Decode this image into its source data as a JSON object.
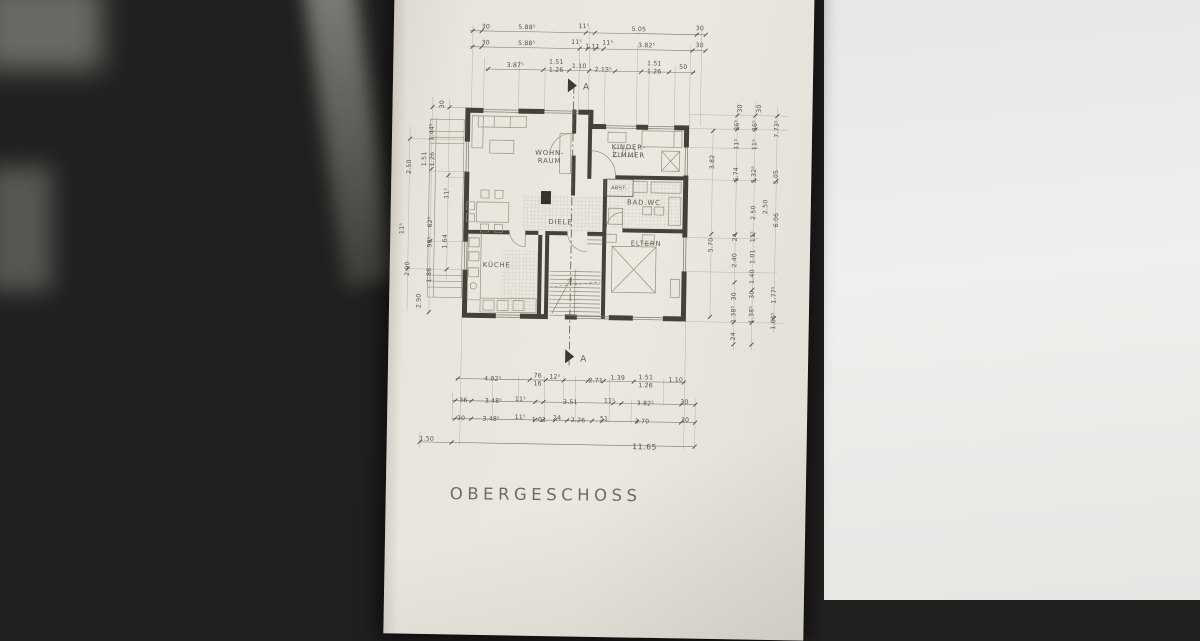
{
  "page_title": "OBERGESCHOSS",
  "section_label": "A",
  "colors": {
    "paper": "#e8e5dd",
    "ink": "#56514a",
    "wall_fill": "#45413a",
    "background": "#21201e",
    "side_surface": "#ecebe9"
  },
  "rooms": [
    {
      "name": "wohnraum",
      "lines": [
        "WOHN-",
        "RAUM"
      ],
      "x": 158,
      "y": 176
    },
    {
      "name": "kinderzimmer",
      "lines": [
        "KINDER-",
        "ZIMMER"
      ],
      "x": 237,
      "y": 169
    },
    {
      "name": "abstellraum",
      "lines": [
        "ABST."
      ],
      "x": 228,
      "y": 206,
      "small": true
    },
    {
      "name": "bad-wc",
      "lines": [
        "BAD.WC"
      ],
      "x": 253,
      "y": 220
    },
    {
      "name": "diele",
      "lines": [
        "DIELE"
      ],
      "x": 170,
      "y": 241
    },
    {
      "name": "eltern",
      "lines": [
        "ELTERN"
      ],
      "x": 256,
      "y": 261
    },
    {
      "name": "kueche",
      "lines": [
        "KÜCHE"
      ],
      "x": 107,
      "y": 285
    }
  ],
  "dim_labels": [
    {
      "t": "30",
      "x": 92,
      "y": 47
    },
    {
      "t": "5.88⁵",
      "x": 133,
      "y": 47
    },
    {
      "t": "11⁵",
      "x": 190,
      "y": 45
    },
    {
      "t": "5.05",
      "x": 245,
      "y": 47
    },
    {
      "t": "30",
      "x": 306,
      "y": 45
    },
    {
      "t": "30",
      "x": 92,
      "y": 63
    },
    {
      "t": "5.88⁵",
      "x": 133,
      "y": 63
    },
    {
      "t": "11⁵",
      "x": 183,
      "y": 61
    },
    {
      "t": "1.11",
      "x": 199,
      "y": 65
    },
    {
      "t": "11⁵",
      "x": 214,
      "y": 61
    },
    {
      "t": "3.82⁵",
      "x": 253,
      "y": 63
    },
    {
      "t": "30",
      "x": 306,
      "y": 62
    },
    {
      "t": "3.87⁵",
      "x": 122,
      "y": 85
    },
    {
      "t": "1.51",
      "x": 163,
      "y": 81
    },
    {
      "t": "1.26",
      "x": 163,
      "y": 89
    },
    {
      "t": "1.10",
      "x": 186,
      "y": 85
    },
    {
      "t": "2.13⁵",
      "x": 210,
      "y": 88
    },
    {
      "t": "1.51",
      "x": 261,
      "y": 81
    },
    {
      "t": "1.26",
      "x": 261,
      "y": 89
    },
    {
      "t": "50",
      "x": 290,
      "y": 84
    },
    {
      "t": "4.02⁵",
      "x": 105,
      "y": 399
    },
    {
      "t": "76",
      "x": 150,
      "y": 395
    },
    {
      "t": "16",
      "x": 150,
      "y": 403
    },
    {
      "t": "12⁵",
      "x": 167,
      "y": 396
    },
    {
      "t": "2.71",
      "x": 208,
      "y": 399
    },
    {
      "t": "1.39",
      "x": 230,
      "y": 396
    },
    {
      "t": "1.51",
      "x": 258,
      "y": 395
    },
    {
      "t": "1.26",
      "x": 258,
      "y": 403
    },
    {
      "t": "1.10",
      "x": 288,
      "y": 397
    },
    {
      "t": "36",
      "x": 76,
      "y": 421
    },
    {
      "t": "3.48⁵",
      "x": 106,
      "y": 421
    },
    {
      "t": "11⁵",
      "x": 133,
      "y": 419
    },
    {
      "t": "3.51",
      "x": 183,
      "y": 421
    },
    {
      "t": "11⁵",
      "x": 222,
      "y": 419
    },
    {
      "t": "3.82⁵",
      "x": 258,
      "y": 421
    },
    {
      "t": "30",
      "x": 297,
      "y": 419
    },
    {
      "t": "30",
      "x": 74,
      "y": 439
    },
    {
      "t": "3.48⁵",
      "x": 104,
      "y": 439
    },
    {
      "t": "11⁵",
      "x": 133,
      "y": 437
    },
    {
      "t": "1.01",
      "x": 152,
      "y": 439
    },
    {
      "t": "24",
      "x": 170,
      "y": 437
    },
    {
      "t": "2.26",
      "x": 191,
      "y": 439
    },
    {
      "t": "51",
      "x": 217,
      "y": 437
    },
    {
      "t": "3.70",
      "x": 255,
      "y": 439
    },
    {
      "t": "30",
      "x": 298,
      "y": 437
    },
    {
      "t": "1.50",
      "x": 40,
      "y": 460
    },
    {
      "t": "11.65",
      "x": 258,
      "y": 464,
      "big": true
    },
    {
      "t": "30",
      "x": 50,
      "y": 125,
      "r": 1
    },
    {
      "t": "2.50",
      "x": 18,
      "y": 188,
      "r": 1
    },
    {
      "t": "1.44⁵",
      "x": 40,
      "y": 153,
      "r": 1
    },
    {
      "t": "1.51",
      "x": 33,
      "y": 180,
      "r": 1
    },
    {
      "t": "1.26",
      "x": 41,
      "y": 180,
      "r": 1
    },
    {
      "t": "11⁵",
      "x": 56,
      "y": 214,
      "r": 1
    },
    {
      "t": "11⁵",
      "x": 12,
      "y": 250,
      "r": 1
    },
    {
      "t": "62⁵",
      "x": 40,
      "y": 243,
      "r": 1
    },
    {
      "t": "1.64",
      "x": 55,
      "y": 262,
      "r": 1
    },
    {
      "t": "98⁵",
      "x": 40,
      "y": 263,
      "r": 1
    },
    {
      "t": "1.86",
      "x": 40,
      "y": 296,
      "r": 1
    },
    {
      "t": "2.90",
      "x": 18,
      "y": 290,
      "r": 1
    },
    {
      "t": "2.90",
      "x": 30,
      "y": 322,
      "r": 1
    },
    {
      "t": "3.82",
      "x": 321,
      "y": 178,
      "r": 1
    },
    {
      "t": "5.70",
      "x": 321,
      "y": 261,
      "r": 1
    },
    {
      "t": "30",
      "x": 348,
      "y": 124,
      "r": 1
    },
    {
      "t": "30",
      "x": 367,
      "y": 124,
      "r": 1
    },
    {
      "t": "36⁵",
      "x": 345,
      "y": 141,
      "r": 1
    },
    {
      "t": "36⁵",
      "x": 363,
      "y": 141,
      "r": 1
    },
    {
      "t": "7.73⁵",
      "x": 385,
      "y": 144,
      "r": 1
    },
    {
      "t": "11⁵",
      "x": 345,
      "y": 160,
      "r": 1
    },
    {
      "t": "11⁵",
      "x": 363,
      "y": 160,
      "r": 1
    },
    {
      "t": "6.74",
      "x": 345,
      "y": 190,
      "r": 1
    },
    {
      "t": "3.32⁵",
      "x": 363,
      "y": 190,
      "r": 1
    },
    {
      "t": "5.05",
      "x": 385,
      "y": 192,
      "r": 1
    },
    {
      "t": "2.50",
      "x": 363,
      "y": 228,
      "r": 1
    },
    {
      "t": "2.50",
      "x": 375,
      "y": 222,
      "r": 1
    },
    {
      "t": "6.06",
      "x": 386,
      "y": 235,
      "r": 1
    },
    {
      "t": "24",
      "x": 345,
      "y": 253,
      "r": 1
    },
    {
      "t": "11⁵",
      "x": 363,
      "y": 252,
      "r": 1
    },
    {
      "t": "2.40",
      "x": 345,
      "y": 276,
      "r": 1
    },
    {
      "t": "1.01",
      "x": 363,
      "y": 272,
      "r": 1
    },
    {
      "t": "1.40",
      "x": 363,
      "y": 292,
      "r": 1
    },
    {
      "t": "30",
      "x": 345,
      "y": 312,
      "r": 1
    },
    {
      "t": "30",
      "x": 363,
      "y": 310,
      "r": 1
    },
    {
      "t": "1.38⁵",
      "x": 345,
      "y": 330,
      "r": 1
    },
    {
      "t": "1.38⁵",
      "x": 363,
      "y": 330,
      "r": 1
    },
    {
      "t": "1.77⁵",
      "x": 385,
      "y": 310,
      "r": 1
    },
    {
      "t": "1.66⁵",
      "x": 385,
      "y": 336,
      "r": 1
    },
    {
      "t": "24",
      "x": 345,
      "y": 352,
      "r": 1
    }
  ]
}
